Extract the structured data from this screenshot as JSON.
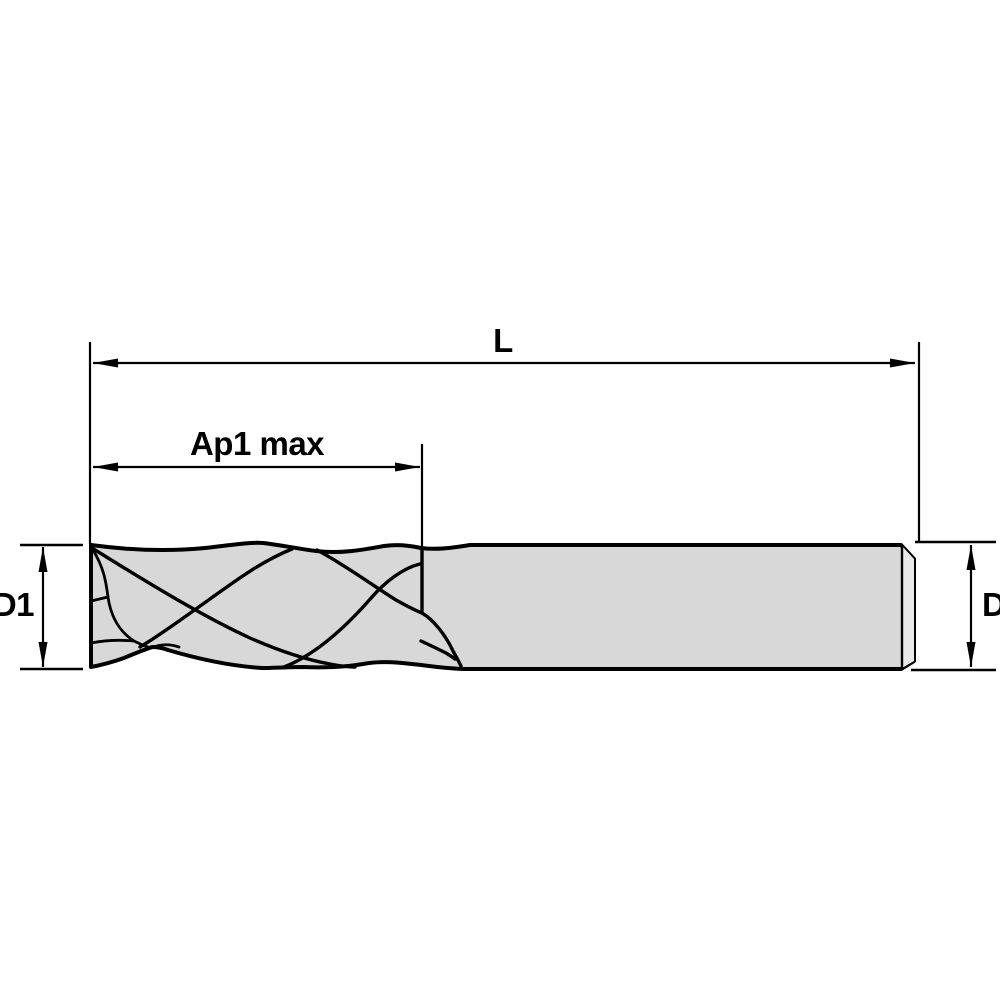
{
  "drawing": {
    "labels": {
      "overall_length": "L",
      "depth_of_cut": "Ap1 max",
      "cutting_diameter": "D1",
      "shank_diameter": "D"
    },
    "colors": {
      "background": "#ffffff",
      "line": "#000000",
      "tool_fill": "#d8d8d8",
      "chamfer_fill": "#e9e9e9"
    }
  }
}
